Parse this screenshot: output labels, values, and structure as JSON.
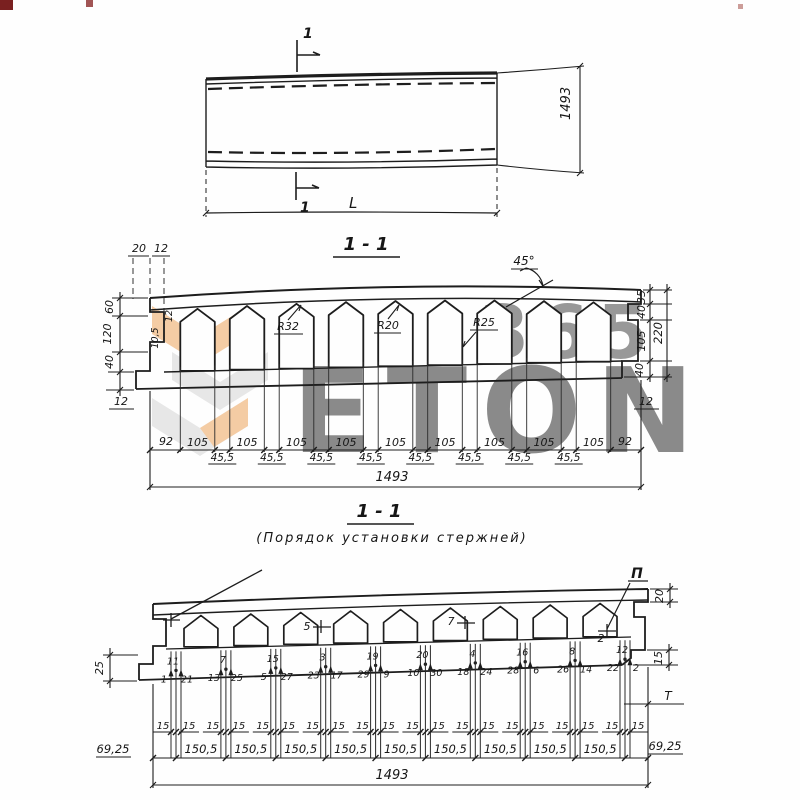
{
  "watermark": {
    "brand": "ETON",
    "number": "365",
    "orange": "#eda45c",
    "gray": "#d9d9d9"
  },
  "plan": {
    "cut_label_top": "1",
    "cut_label_bottom": "1",
    "length_label": "L",
    "width_label": "1493"
  },
  "section1": {
    "title": "1 - 1",
    "top_left_dims": [
      "20",
      "12"
    ],
    "left_heights": [
      "60",
      "120",
      "40"
    ],
    "left_bottom_dim": "12",
    "left_rib_dims": [
      "12",
      "10,5"
    ],
    "angle_label": "45°",
    "radius_labels": [
      "R32",
      "R20",
      "R25"
    ],
    "right_heights": [
      "35",
      "40",
      "105",
      "40"
    ],
    "right_total": "220",
    "right_bottom_dim": "12",
    "edge_dims": [
      "92",
      "92"
    ],
    "opening_dims": [
      "105",
      "105",
      "105",
      "105",
      "105",
      "105",
      "105",
      "105",
      "105"
    ],
    "rib_dims": [
      "45,5",
      "45,5",
      "45,5",
      "45,5",
      "45,5",
      "45,5",
      "45,5",
      "45,5"
    ],
    "total_dim": "1493"
  },
  "section2": {
    "title": "1 - 1",
    "subtitle": "(Порядок установки стержней)",
    "datum_label": "П",
    "tee_label": "Т",
    "top_marks": [
      "5",
      "7",
      "2"
    ],
    "left_dim": "25",
    "right_dims": [
      "20",
      "15"
    ],
    "clusters": [
      {
        "left": "1",
        "top": "11",
        "right": "21"
      },
      {
        "left": "13",
        "top": "7",
        "right": "25"
      },
      {
        "left": "5",
        "top": "15",
        "right": "27"
      },
      {
        "left": "23",
        "top": "3",
        "right": "17"
      },
      {
        "left": "29",
        "top": "19",
        "right": "9"
      },
      {
        "left": "10",
        "top": "20",
        "right": "30"
      },
      {
        "left": "18",
        "top": "4",
        "right": "24"
      },
      {
        "left": "28",
        "top": "16",
        "right": "6"
      },
      {
        "left": "26",
        "top": "8",
        "right": "14"
      },
      {
        "left": "22",
        "top": "12",
        "right": "2"
      }
    ],
    "offset_dims": [
      "15",
      "15",
      "15",
      "15",
      "15",
      "15",
      "15",
      "15",
      "15",
      "15",
      "15",
      "15",
      "15",
      "15",
      "15",
      "15",
      "15",
      "15",
      "15",
      "15"
    ],
    "pitch_dims": [
      "150,5",
      "150,5",
      "150,5",
      "150,5",
      "150,5",
      "150,5",
      "150,5",
      "150,5",
      "150,5"
    ],
    "edge_dims": [
      "69,25",
      "69,25"
    ],
    "total_dim": "1493"
  }
}
